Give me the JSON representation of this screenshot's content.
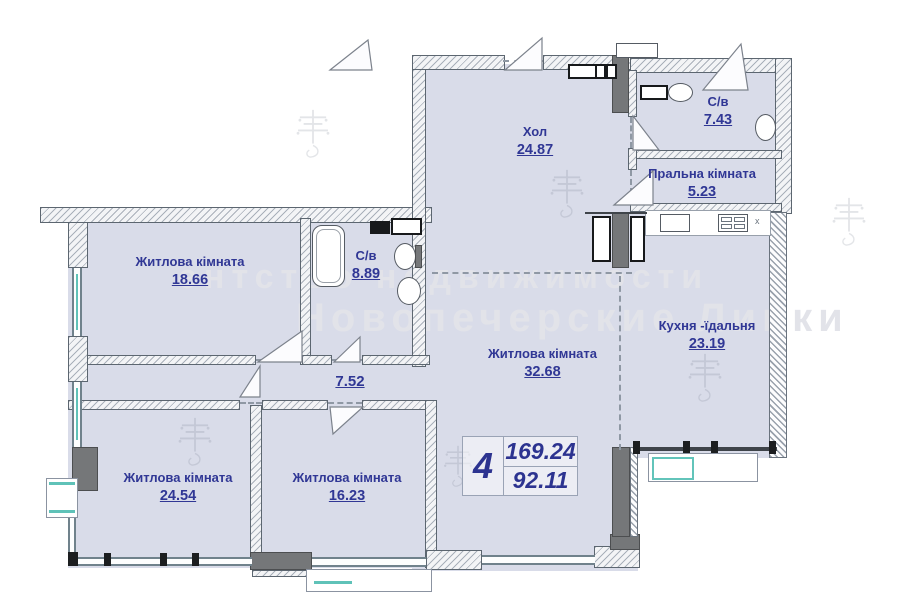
{
  "plan": {
    "rooms": [
      {
        "id": "hall",
        "name": "Хол",
        "area": "24.87"
      },
      {
        "id": "bathroom-small",
        "name": "С/в",
        "area": "7.43"
      },
      {
        "id": "laundry",
        "name": "Пральна кімната",
        "area": "5.23"
      },
      {
        "id": "living-1",
        "name": "Житлова кімната",
        "area": "18.66"
      },
      {
        "id": "bathroom-main",
        "name": "С/в",
        "area": "8.89"
      },
      {
        "id": "living-main",
        "name": "Житлова кімната",
        "area": "32.68"
      },
      {
        "id": "kitchen-dining",
        "name": "Кухня -їдальня",
        "area": "23.19"
      },
      {
        "id": "corridor",
        "name": "",
        "area": "7.52"
      },
      {
        "id": "living-2",
        "name": "Житлова кімната",
        "area": "24.54"
      },
      {
        "id": "living-3",
        "name": "Житлова кімната",
        "area": "16.23"
      }
    ],
    "summary": {
      "rooms_count": "4",
      "total_area": "169.24",
      "living_area": "92.11"
    },
    "watermark": {
      "line1": "ентство недвижимости",
      "line2": "Новопечерские Липки"
    },
    "x_marker": "x",
    "colors": {
      "room_fill": "#d9dce9",
      "label": "#303795",
      "wall_gray": "#757779",
      "teal": "#5fc2b8",
      "watermark": "#e2e3e9"
    }
  }
}
